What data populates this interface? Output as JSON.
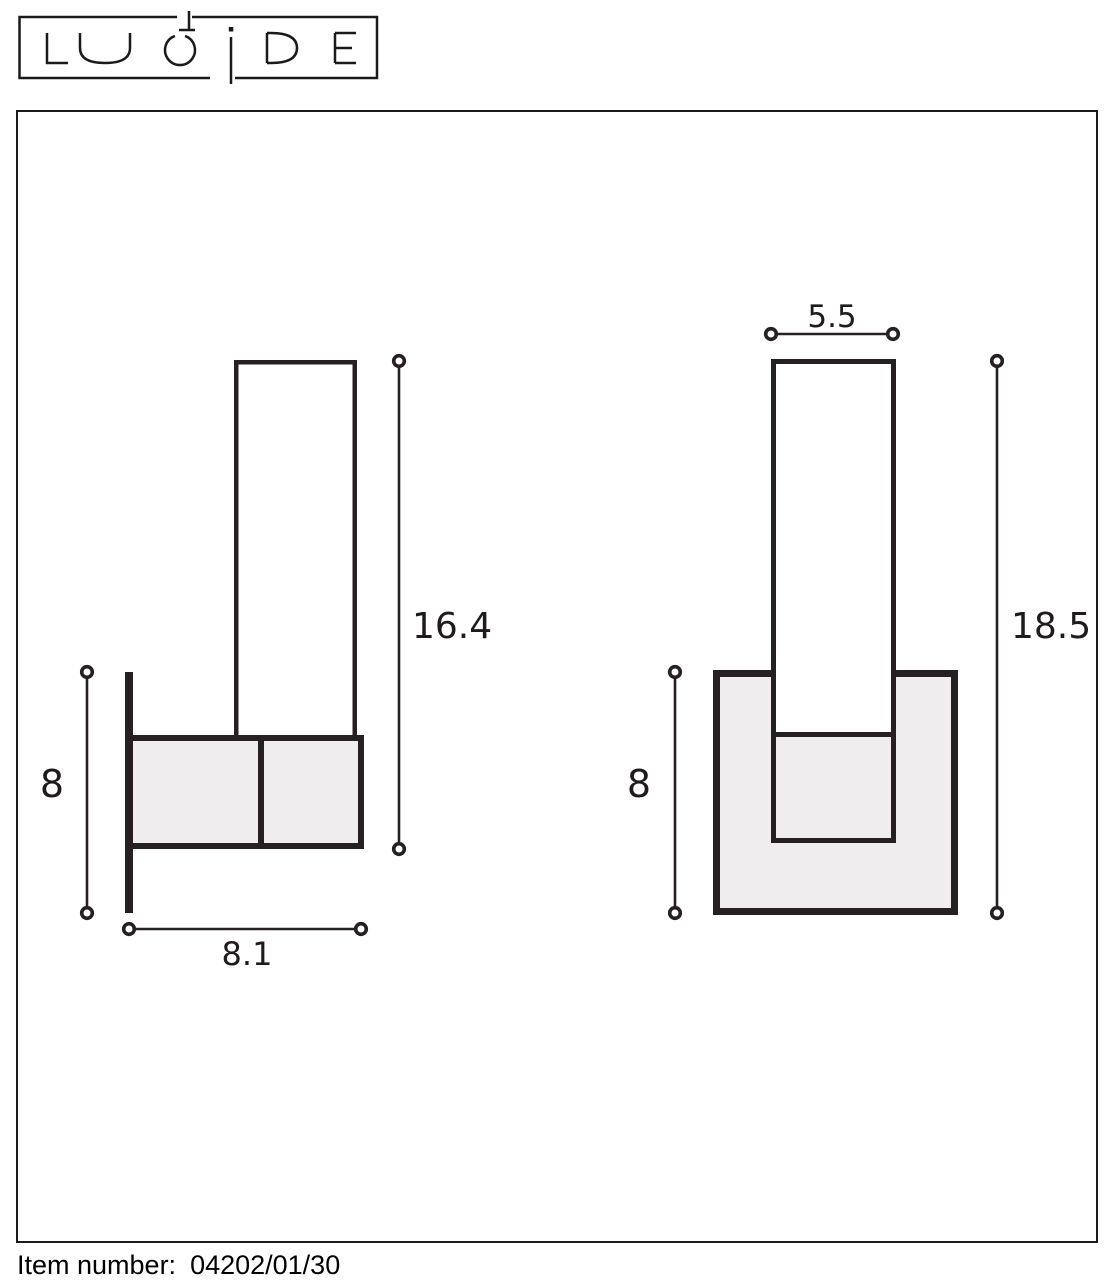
{
  "logo": {
    "brand": "LUCIDE"
  },
  "drawing": {
    "side_view": {
      "name": "wall lamp side view",
      "height_dim": "16.4",
      "depth_dim": "8",
      "width_dim": "8.1"
    },
    "front_view": {
      "name": "wall lamp front view",
      "tube_width_dim": "5.5",
      "height_dim": "18.5",
      "housing_dim": "8"
    }
  },
  "footer": {
    "label": "Item number:",
    "value": "04202/01/30"
  },
  "colors": {
    "line": "#262022",
    "panel_fill": "#efedee",
    "logo_line": "#1a1a1a"
  }
}
